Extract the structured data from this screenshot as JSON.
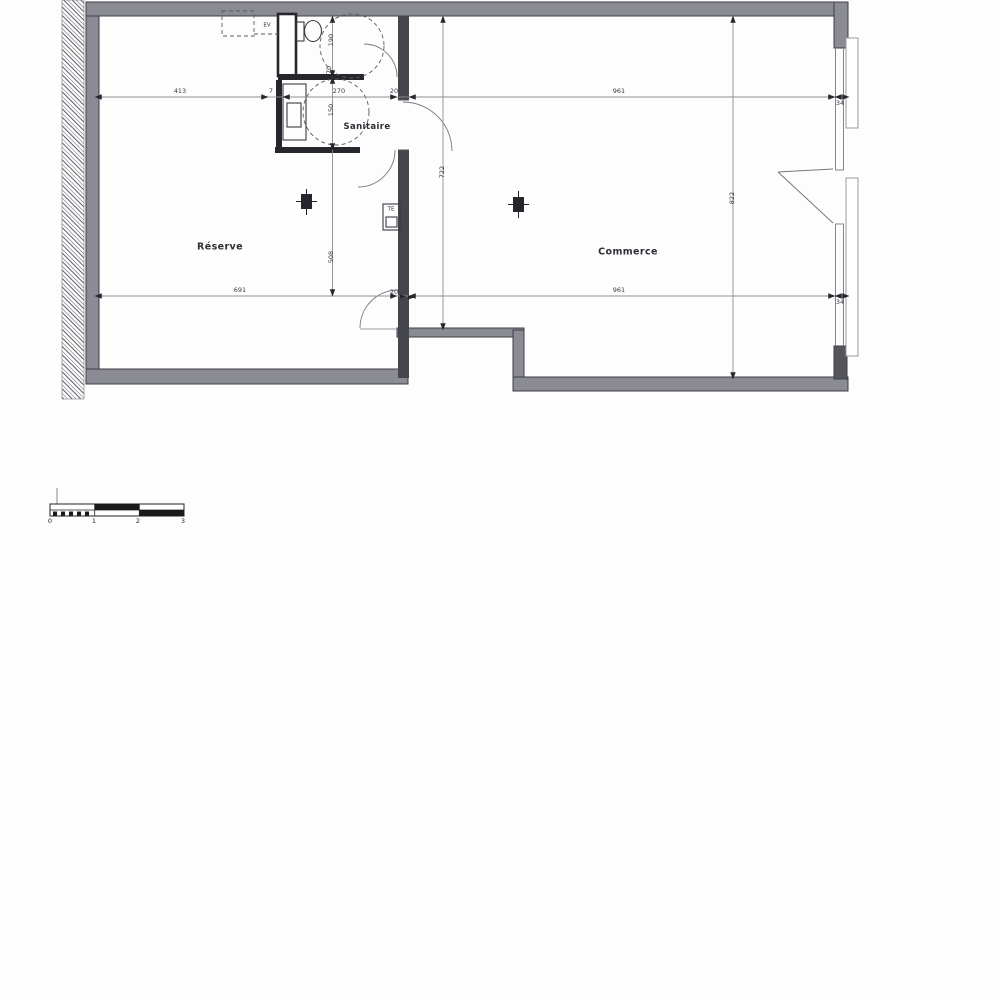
{
  "plan": {
    "type": "architectural-floor-plan",
    "rooms": {
      "reserve": "Réserve",
      "sanitaire": "Sanitaire",
      "commerce": "Commerce"
    },
    "annotations": {
      "ev": "EV",
      "te": "TE"
    },
    "dims": {
      "top_413": "413",
      "top_7": "7",
      "top_270": "270",
      "top_20": "20",
      "top_961": "961",
      "top_34": "34",
      "bot_691": "691",
      "bot_20": "20",
      "bot_961": "961",
      "bot_34": "34",
      "v_190": "190",
      "v_70": "70",
      "v_150": "150",
      "v_508": "508",
      "v_722": "722",
      "v_822": "822"
    },
    "scale_bar": {
      "ticks": [
        "0",
        "1",
        "2",
        "3"
      ]
    },
    "colors": {
      "wall_fill": "#8b8b93",
      "wall_edge": "#3e3e46",
      "partition_dark": "#26262c",
      "divider": "#45454d",
      "dim_line": "#8e8e92",
      "dashed": "#5a5a60",
      "paper": "#fdfdfe"
    }
  }
}
